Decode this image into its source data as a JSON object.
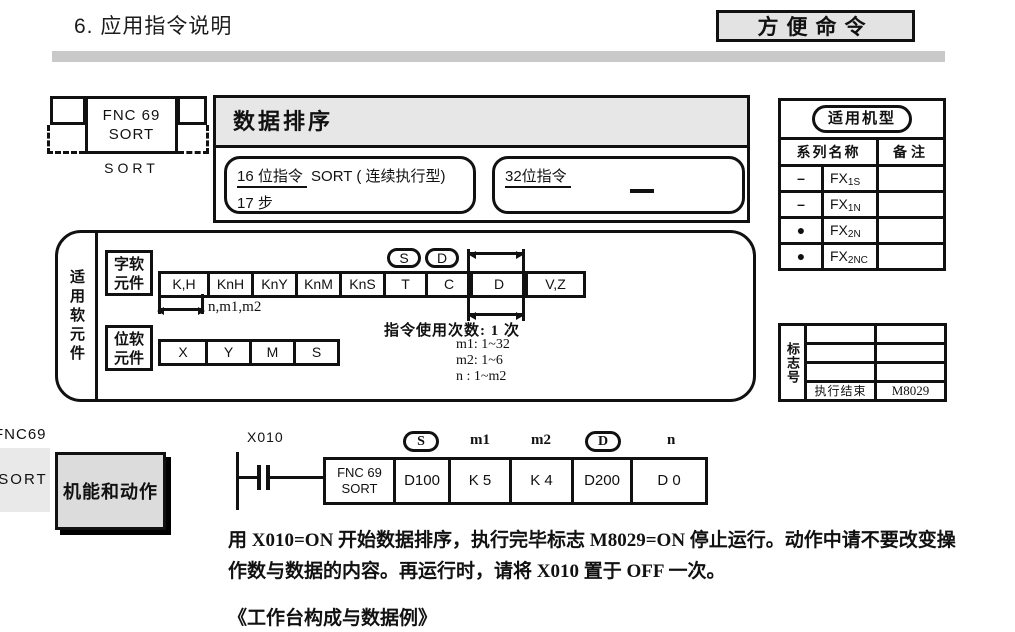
{
  "page": {
    "title": "6. 应用指令说明",
    "corner_tag": "方便命令"
  },
  "symbol": {
    "box_line1": "FNC 69",
    "box_line2": "SORT",
    "caption": "SORT"
  },
  "header": {
    "title": "数据排序",
    "bit16_label": "16 位指令",
    "bit16_rest": "SORT ( 连续执行型)",
    "bit16_steps": "17 步",
    "bit32_label": "32位指令"
  },
  "models": {
    "title": "适用机型",
    "header_series": "系列名称",
    "header_note": "备注",
    "rows": [
      {
        "mark": "–",
        "base": "FX",
        "sub": "1S",
        "note": ""
      },
      {
        "mark": "–",
        "base": "FX",
        "sub": "1N",
        "note": ""
      },
      {
        "mark": "●",
        "base": "FX",
        "sub": "2N",
        "note": ""
      },
      {
        "mark": "●",
        "base": "FX",
        "sub": "2NC",
        "note": ""
      }
    ]
  },
  "devices": {
    "section_label": "适用软元件",
    "word_label_line1": "字软",
    "word_label_line2": "元件",
    "bit_label_line1": "位软",
    "bit_label_line2": "元件",
    "word_cells": [
      "K,H",
      "KnH",
      "KnY",
      "KnM",
      "KnS",
      "T",
      "C",
      "D",
      "V,Z"
    ],
    "bit_cells": [
      "X",
      "Y",
      "M",
      "S"
    ],
    "s_tag": "S",
    "d_tag": "D",
    "range_note": "n,m1,m2",
    "usage_title": "指令使用次数: 1 次",
    "usage_m1": "m1: 1~32",
    "usage_m2": "m2: 1~6",
    "usage_n": "n : 1~m2"
  },
  "flags": {
    "section_label": "标志号",
    "rows": [
      {
        "name": "",
        "value": ""
      },
      {
        "name": "",
        "value": ""
      },
      {
        "name": "",
        "value": ""
      },
      {
        "name": "执行结束",
        "value": "M8029"
      }
    ]
  },
  "function_section": {
    "side_tab_line1": "FNC69",
    "side_tab_line2": "SORT",
    "heading": "机能和动作"
  },
  "ladder": {
    "contact_label": "X010",
    "box_line1": "FNC 69",
    "box_line2": "SORT",
    "operands": [
      {
        "tag": "S",
        "value": "D100"
      },
      {
        "tag": "m1",
        "value": "K 5"
      },
      {
        "tag": "m2",
        "value": "K 4"
      },
      {
        "tag": "D",
        "value": "D200"
      },
      {
        "tag": "n",
        "value": "D 0"
      }
    ]
  },
  "body": {
    "lines": [
      "用 X010=ON 开始数据排序，执行完毕标志 M8029=ON 停止运行。动作中请不要改变操",
      "作数与数据的内容。再运行时，请将 X010 置于 OFF 一次。"
    ],
    "subtitle": "《工作台构成与数据例》"
  },
  "colors": {
    "ink": "#111111",
    "title_bar_gray": "#c9c9c9",
    "header_fill": "#e7e7e7",
    "corner_fill": "#e3e3e3",
    "function_fill": "#dcdcdc",
    "side_tab_fill": "#e9e9e9"
  }
}
